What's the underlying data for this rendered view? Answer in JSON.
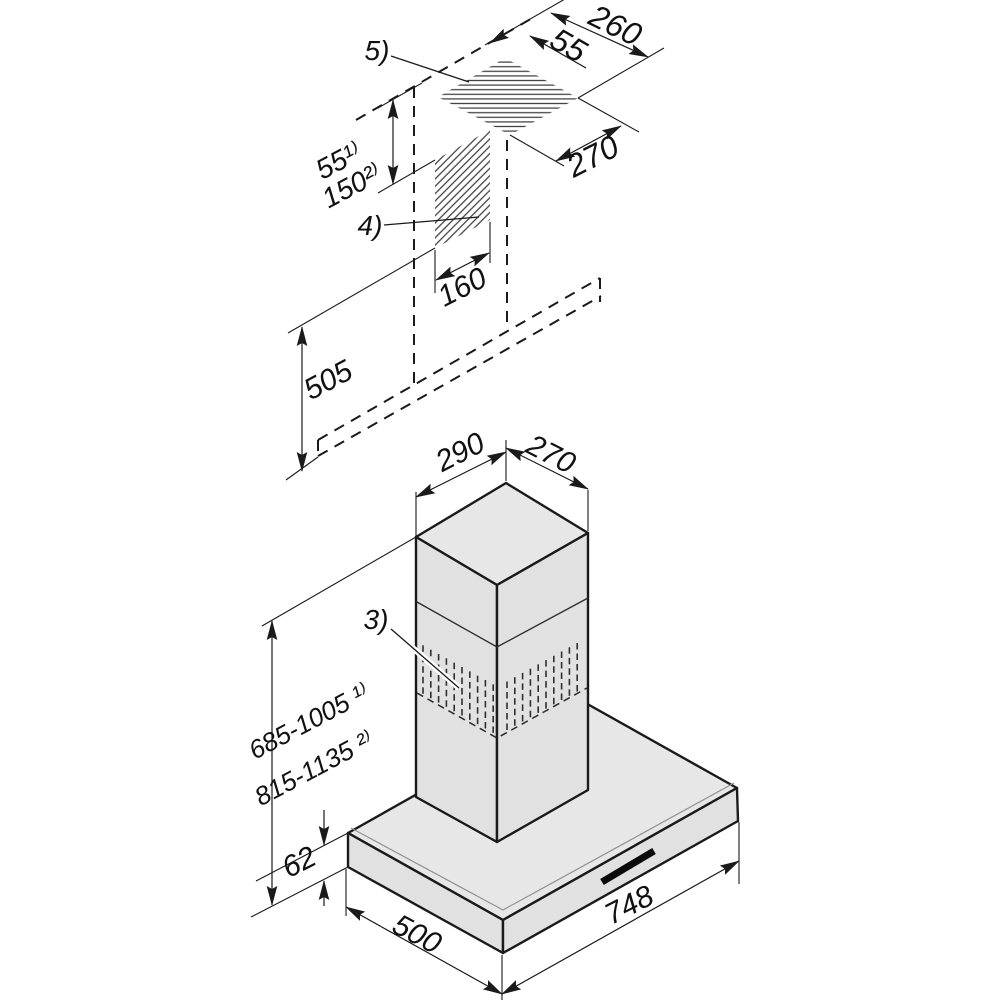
{
  "title": "Cooker hood installation dimension diagram",
  "colors": {
    "background": "#ffffff",
    "line": "#1a1a1a",
    "face_top": "#e7e7e7",
    "face_side": "#e1e1e1",
    "hatch": "#3f3f3f",
    "text": "#111111"
  },
  "labels": {
    "ceiling_cutout_width": "260",
    "ceiling_wall_gap": "55",
    "ceiling_cutout_depth": "270",
    "duct_offset_note1": "55¹⁾",
    "duct_offset_note2": "150²⁾",
    "callout_ceiling": "5)",
    "callout_wall_duct": "4)",
    "callout_vent": "3)",
    "wall_duct_width": "160",
    "wall_section_height": "505",
    "chimney_top_width": "290",
    "chimney_top_depth": "270",
    "height_range_note1": "685-1005 ¹⁾",
    "height_range_note2": "815-1135 ²⁾",
    "canopy_height": "62",
    "canopy_depth": "500",
    "canopy_width": "748"
  }
}
